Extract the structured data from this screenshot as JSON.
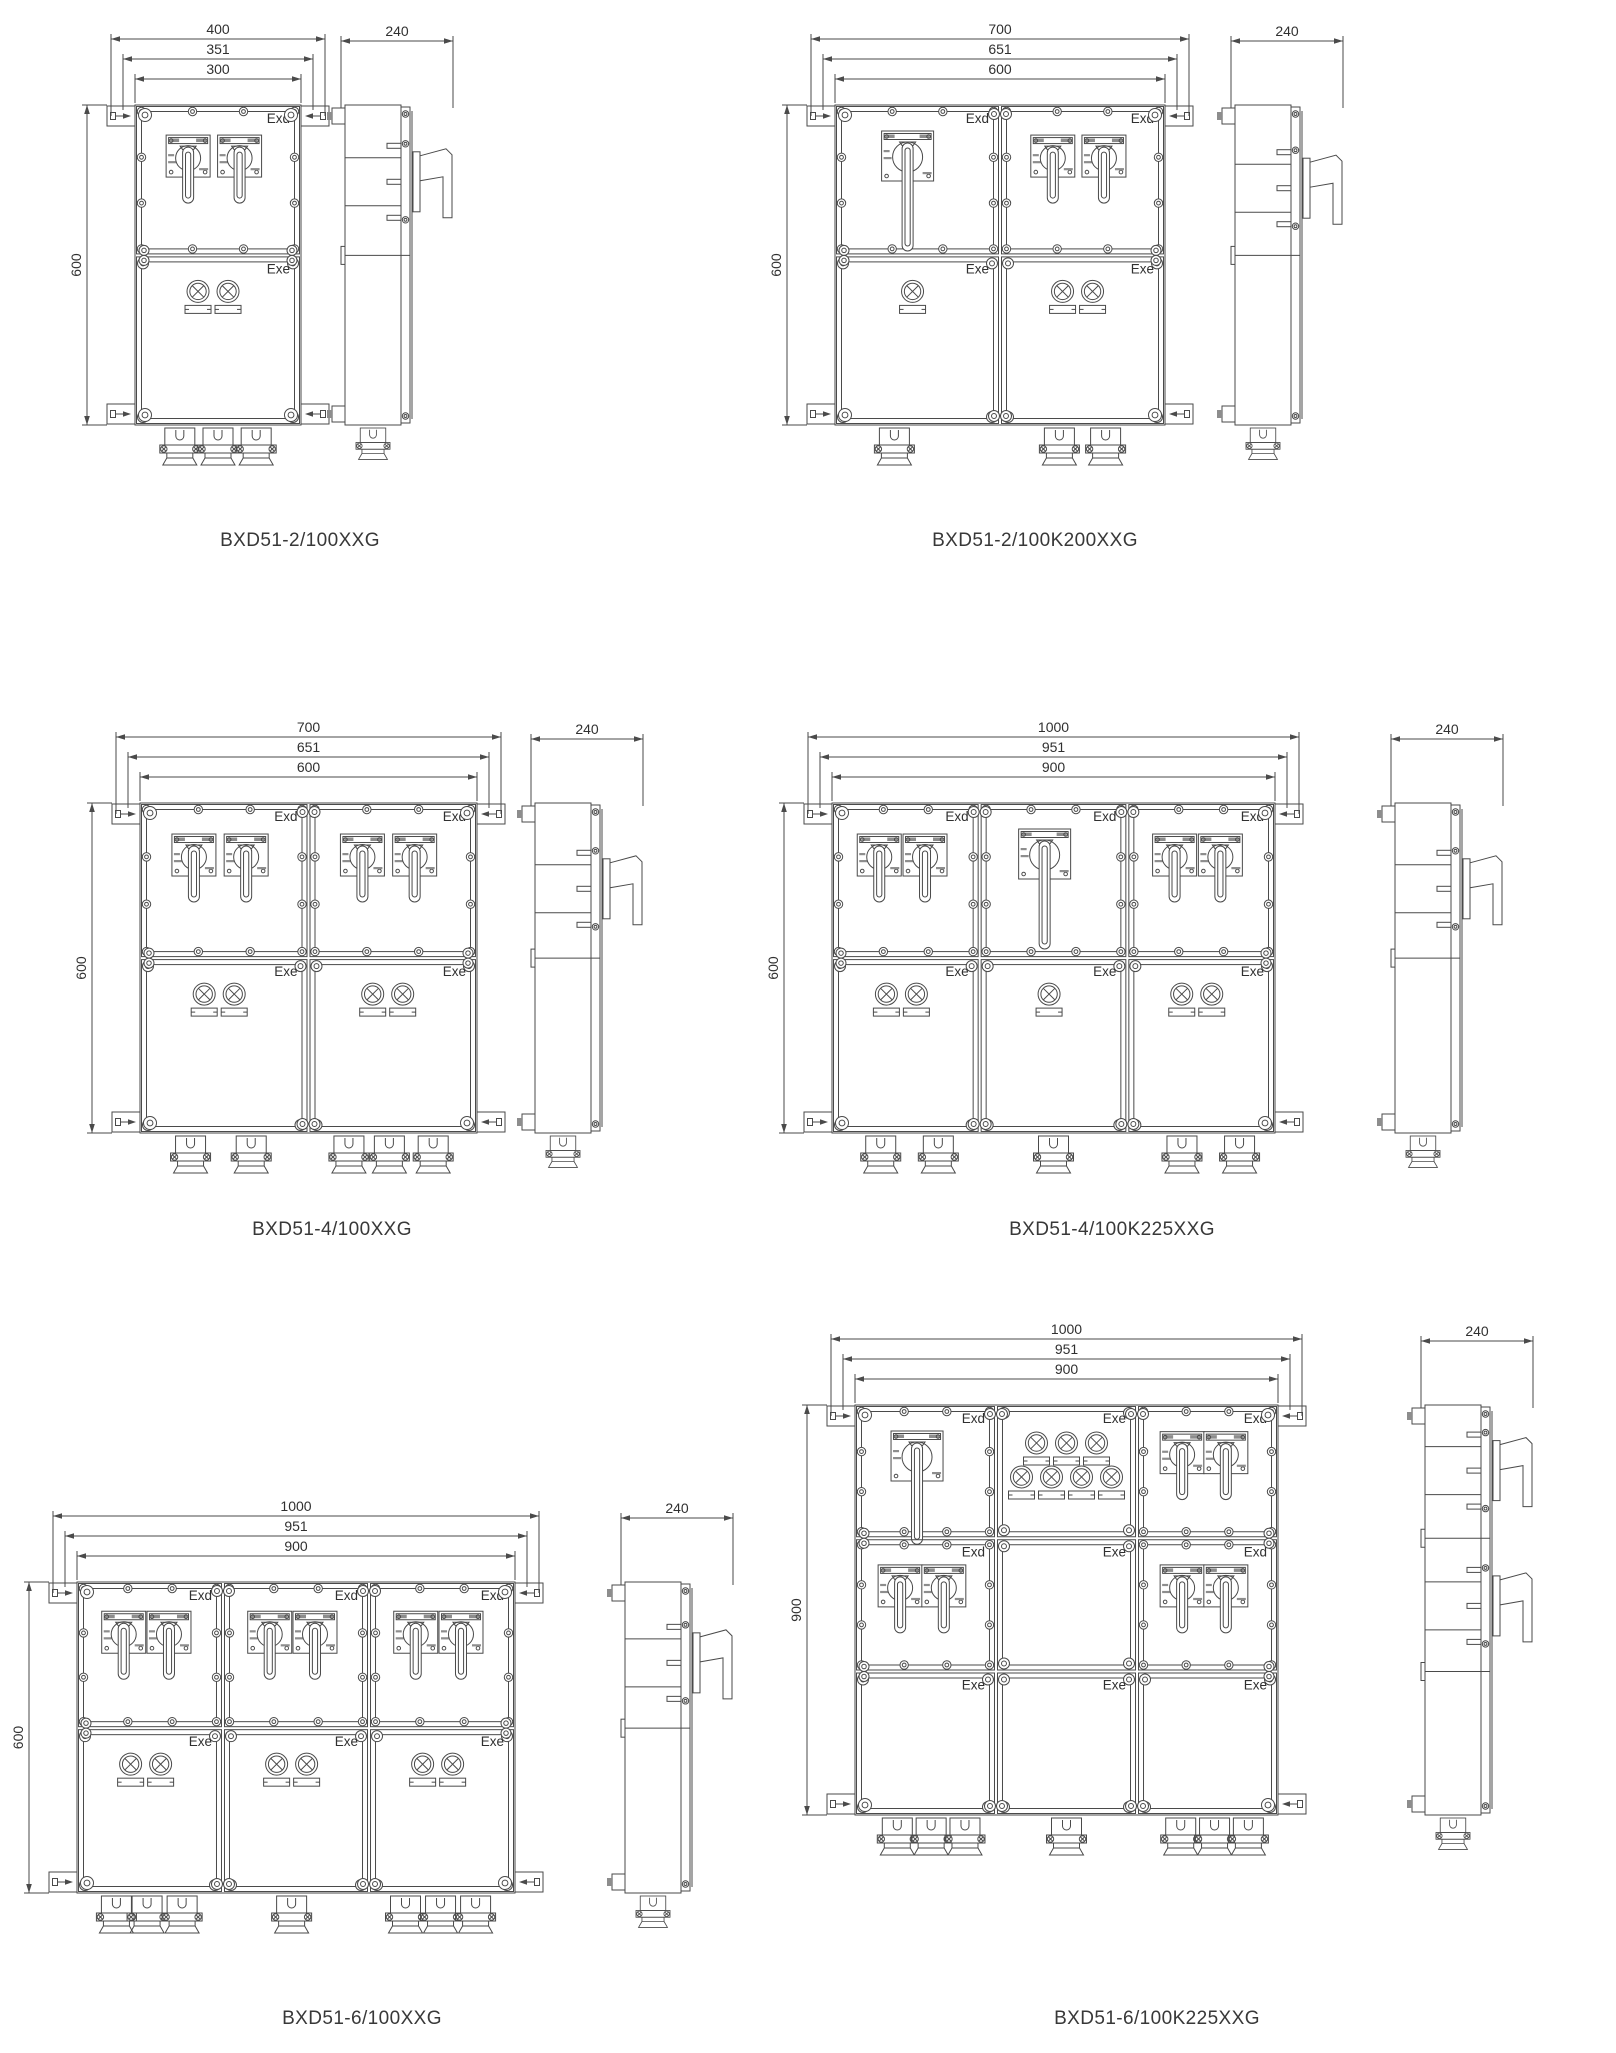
{
  "page": {
    "title": "BXD51 explosion-proof distribution box dimension drawings",
    "background": "#ffffff",
    "line_color": "#4a4a4a"
  },
  "diagrams": [
    {
      "caption": "BXD51-2/100XXG",
      "front": {
        "dims_top": [
          "400",
          "351",
          "300"
        ],
        "dim_left": "600",
        "cells": [
          {
            "x": 0,
            "y": 0,
            "w": 1,
            "h": 0.47,
            "label": "Exd",
            "content": {
              "type": "switches",
              "count": 2,
              "big": false
            }
          },
          {
            "x": 0,
            "y": 0.47,
            "w": 1,
            "h": 0.53,
            "label": "Exe",
            "content": {
              "type": "lamps",
              "count": 2
            }
          }
        ],
        "glands": [
          0.27,
          0.5,
          0.73
        ]
      },
      "side": {
        "dim_top": "240",
        "handles": [
          0.24
        ],
        "rows": [
          0.47
        ]
      }
    },
    {
      "caption": "BXD51-2/100K200XXG",
      "front": {
        "dims_top": [
          "700",
          "651",
          "600"
        ],
        "dim_left": "600",
        "cells": [
          {
            "x": 0,
            "y": 0,
            "w": 0.5,
            "h": 0.47,
            "label": "Exd",
            "content": {
              "type": "switches",
              "count": 1,
              "big": true
            }
          },
          {
            "x": 0.5,
            "y": 0,
            "w": 0.5,
            "h": 0.47,
            "label": "Exd",
            "content": {
              "type": "switches",
              "count": 2,
              "big": false
            }
          },
          {
            "x": 0,
            "y": 0.47,
            "w": 0.5,
            "h": 0.53,
            "label": "Exe",
            "content": {
              "type": "lamps",
              "count": 1
            }
          },
          {
            "x": 0.5,
            "y": 0.47,
            "w": 0.5,
            "h": 0.53,
            "label": "Exe",
            "content": {
              "type": "lamps",
              "count": 2
            }
          }
        ],
        "glands": [
          0.18,
          0.68,
          0.82
        ]
      },
      "side": {
        "dim_top": "240",
        "handles": [
          0.26
        ],
        "rows": [
          0.47
        ]
      }
    },
    {
      "caption": "BXD51-4/100XXG",
      "front": {
        "dims_top": [
          "700",
          "651",
          "600"
        ],
        "dim_left": "600",
        "cells": [
          {
            "x": 0,
            "y": 0,
            "w": 0.5,
            "h": 0.47,
            "label": "Exd",
            "content": {
              "type": "switches",
              "count": 2,
              "big": false
            }
          },
          {
            "x": 0.5,
            "y": 0,
            "w": 0.5,
            "h": 0.47,
            "label": "Exd",
            "content": {
              "type": "switches",
              "count": 2,
              "big": false
            }
          },
          {
            "x": 0,
            "y": 0.47,
            "w": 0.5,
            "h": 0.53,
            "label": "Exe",
            "content": {
              "type": "lamps",
              "count": 2
            }
          },
          {
            "x": 0.5,
            "y": 0.47,
            "w": 0.5,
            "h": 0.53,
            "label": "Exe",
            "content": {
              "type": "lamps",
              "count": 2
            }
          }
        ],
        "glands": [
          0.15,
          0.33,
          0.62,
          0.74,
          0.87
        ]
      },
      "side": {
        "dim_top": "240",
        "handles": [
          0.26
        ],
        "rows": [
          0.47
        ]
      }
    },
    {
      "caption": "BXD51-4/100K225XXG",
      "front": {
        "dims_top": [
          "1000",
          "951",
          "900"
        ],
        "dim_left": "600",
        "cells": [
          {
            "x": 0,
            "y": 0,
            "w": 0.3333,
            "h": 0.47,
            "label": "Exd",
            "content": {
              "type": "switches",
              "count": 2,
              "big": false
            }
          },
          {
            "x": 0.3333,
            "y": 0,
            "w": 0.3334,
            "h": 0.47,
            "label": "Exd",
            "content": {
              "type": "switches",
              "count": 1,
              "big": true
            }
          },
          {
            "x": 0.6667,
            "y": 0,
            "w": 0.3333,
            "h": 0.47,
            "label": "Exd",
            "content": {
              "type": "switches",
              "count": 2,
              "big": false
            }
          },
          {
            "x": 0,
            "y": 0.47,
            "w": 0.3333,
            "h": 0.53,
            "label": "Exe",
            "content": {
              "type": "lamps",
              "count": 2
            }
          },
          {
            "x": 0.3333,
            "y": 0.47,
            "w": 0.3334,
            "h": 0.53,
            "label": "Exe",
            "content": {
              "type": "lamps",
              "count": 1
            }
          },
          {
            "x": 0.6667,
            "y": 0.47,
            "w": 0.3333,
            "h": 0.53,
            "label": "Exe",
            "content": {
              "type": "lamps",
              "count": 2
            }
          }
        ],
        "glands": [
          0.11,
          0.24,
          0.5,
          0.79,
          0.92
        ]
      },
      "side": {
        "dim_top": "240",
        "handles": [
          0.26
        ],
        "rows": [
          0.47
        ]
      }
    },
    {
      "caption": "BXD51-6/100XXG",
      "front": {
        "dims_top": [
          "1000",
          "951",
          "900"
        ],
        "dim_left": "600",
        "cells": [
          {
            "x": 0,
            "y": 0,
            "w": 0.3333,
            "h": 0.47,
            "label": "Exd",
            "content": {
              "type": "switches",
              "count": 2,
              "big": false
            }
          },
          {
            "x": 0.3333,
            "y": 0,
            "w": 0.3334,
            "h": 0.47,
            "label": "Exd",
            "content": {
              "type": "switches",
              "count": 2,
              "big": false
            }
          },
          {
            "x": 0.6667,
            "y": 0,
            "w": 0.3333,
            "h": 0.47,
            "label": "Exd",
            "content": {
              "type": "switches",
              "count": 2,
              "big": false
            }
          },
          {
            "x": 0,
            "y": 0.47,
            "w": 0.3333,
            "h": 0.53,
            "label": "Exe",
            "content": {
              "type": "lamps",
              "count": 2
            }
          },
          {
            "x": 0.3333,
            "y": 0.47,
            "w": 0.3334,
            "h": 0.53,
            "label": "Exe",
            "content": {
              "type": "lamps",
              "count": 2
            }
          },
          {
            "x": 0.6667,
            "y": 0.47,
            "w": 0.3333,
            "h": 0.53,
            "label": "Exe",
            "content": {
              "type": "lamps",
              "count": 2
            }
          }
        ],
        "glands": [
          0.09,
          0.16,
          0.24,
          0.49,
          0.75,
          0.83,
          0.91
        ]
      },
      "side": {
        "dim_top": "240",
        "handles": [
          0.26
        ],
        "rows": [
          0.47
        ]
      }
    },
    {
      "caption": "BXD51-6/100K225XXG",
      "front": {
        "dims_top": [
          "1000",
          "951",
          "900"
        ],
        "dim_left": "900",
        "cells": [
          {
            "x": 0,
            "y": 0,
            "w": 0.3333,
            "h": 0.325,
            "label": "Exd",
            "content": {
              "type": "switches",
              "count": 1,
              "big": true
            }
          },
          {
            "x": 0.3333,
            "y": 0,
            "w": 0.3334,
            "h": 0.325,
            "label": "Exe",
            "content": {
              "type": "lamp_grid",
              "rows": [
                3,
                4
              ]
            }
          },
          {
            "x": 0.6667,
            "y": 0,
            "w": 0.3333,
            "h": 0.325,
            "label": "Exd",
            "content": {
              "type": "switches",
              "count": 2,
              "big": false
            }
          },
          {
            "x": 0,
            "y": 0.325,
            "w": 0.3333,
            "h": 0.325,
            "label": "Exd",
            "content": {
              "type": "switches",
              "count": 2,
              "big": false
            }
          },
          {
            "x": 0.3333,
            "y": 0.325,
            "w": 0.3334,
            "h": 0.325,
            "label": "Exe",
            "content": {
              "type": "none"
            }
          },
          {
            "x": 0.6667,
            "y": 0.325,
            "w": 0.3333,
            "h": 0.325,
            "label": "Exd",
            "content": {
              "type": "switches",
              "count": 2,
              "big": false
            }
          },
          {
            "x": 0,
            "y": 0.65,
            "w": 0.3333,
            "h": 0.35,
            "label": "Exe",
            "content": {
              "type": "none"
            }
          },
          {
            "x": 0.3333,
            "y": 0.65,
            "w": 0.3334,
            "h": 0.35,
            "label": "Exe",
            "content": {
              "type": "none"
            }
          },
          {
            "x": 0.6667,
            "y": 0.65,
            "w": 0.3333,
            "h": 0.35,
            "label": "Exe",
            "content": {
              "type": "none"
            }
          }
        ],
        "glands": [
          0.1,
          0.18,
          0.26,
          0.5,
          0.77,
          0.85,
          0.93
        ]
      },
      "side": {
        "dim_top": "240",
        "handles": [
          0.16,
          0.49
        ],
        "rows": [
          0.325,
          0.65
        ]
      }
    }
  ]
}
